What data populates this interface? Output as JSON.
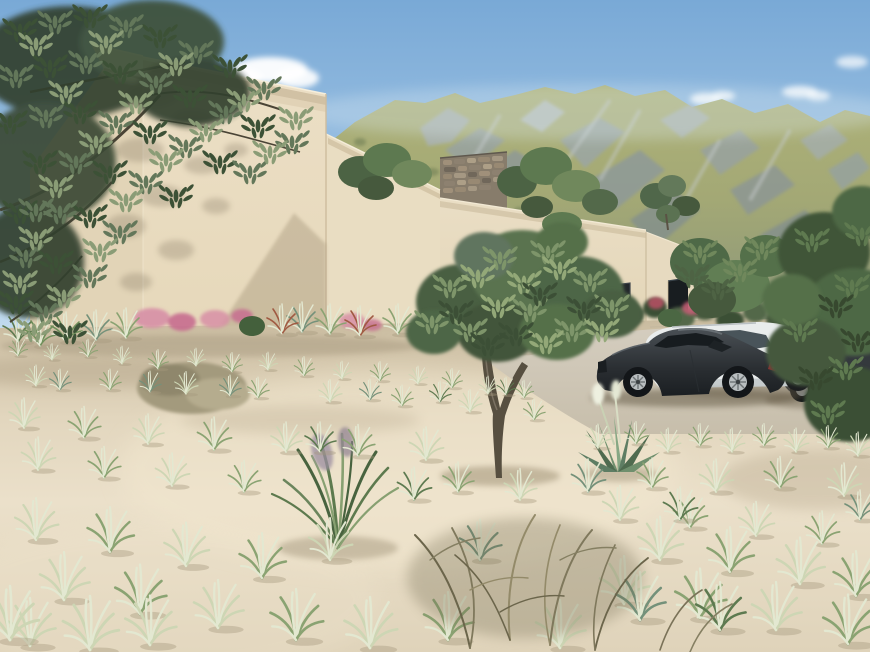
{
  "scene": {
    "title": "Photorealistic exterior rendering of a modern flat-roof beige villa with olive trees, dune grasses, mountains and parked cars",
    "objects": [
      "blue sky with scattered white clouds",
      "green rocky mountain ridge with grey outcrops",
      "modern beige stucco villa with stepped flat-roof volumes",
      "projecting roof slab at top left",
      "natural stone accent wall",
      "dark recessed garage entrance",
      "narrow dark window on right wing",
      "large olive tree at top left",
      "gnarled olive tree in foreground",
      "roof terrace shrubs",
      "planting bed with pink muhly grass and agaves",
      "sandy dune foreground with pale grass tufts",
      "dry twiggy shrub",
      "agave rosette with white plumes",
      "concrete parking court",
      "dark grey sports coupe",
      "white estate car",
      "dark grey car partially hidden by tree"
    ]
  },
  "palette": {
    "sky-top": "#79a9d6",
    "sky-mid": "#a6c8e6",
    "sky-horizon": "#d9ebf6",
    "cloud-white": "#ffffff",
    "mountain-grass": "#aeb278",
    "mountain-rock": "#9aa5a8",
    "wall-lit": "#ecdfc6",
    "wall-shadow": "#d9caad",
    "stone-wall": "#877c6b",
    "opening-dark": "#23272b",
    "sand-lit": "#ebe0ca",
    "sand-shade": "#c9bb9f",
    "driveway": "#d5cec0",
    "foliage-dark": "#3c5136",
    "foliage-mid": "#5d7a50",
    "foliage-light": "#8fa573",
    "grass-pale": "#cdd6b4",
    "flower-pink": "#d78fa6",
    "car-dark": "#2a2e32",
    "car-white": "#e9ecec",
    "rim-silver": "#b9bec0",
    "trunk-brown": "#574f40"
  }
}
